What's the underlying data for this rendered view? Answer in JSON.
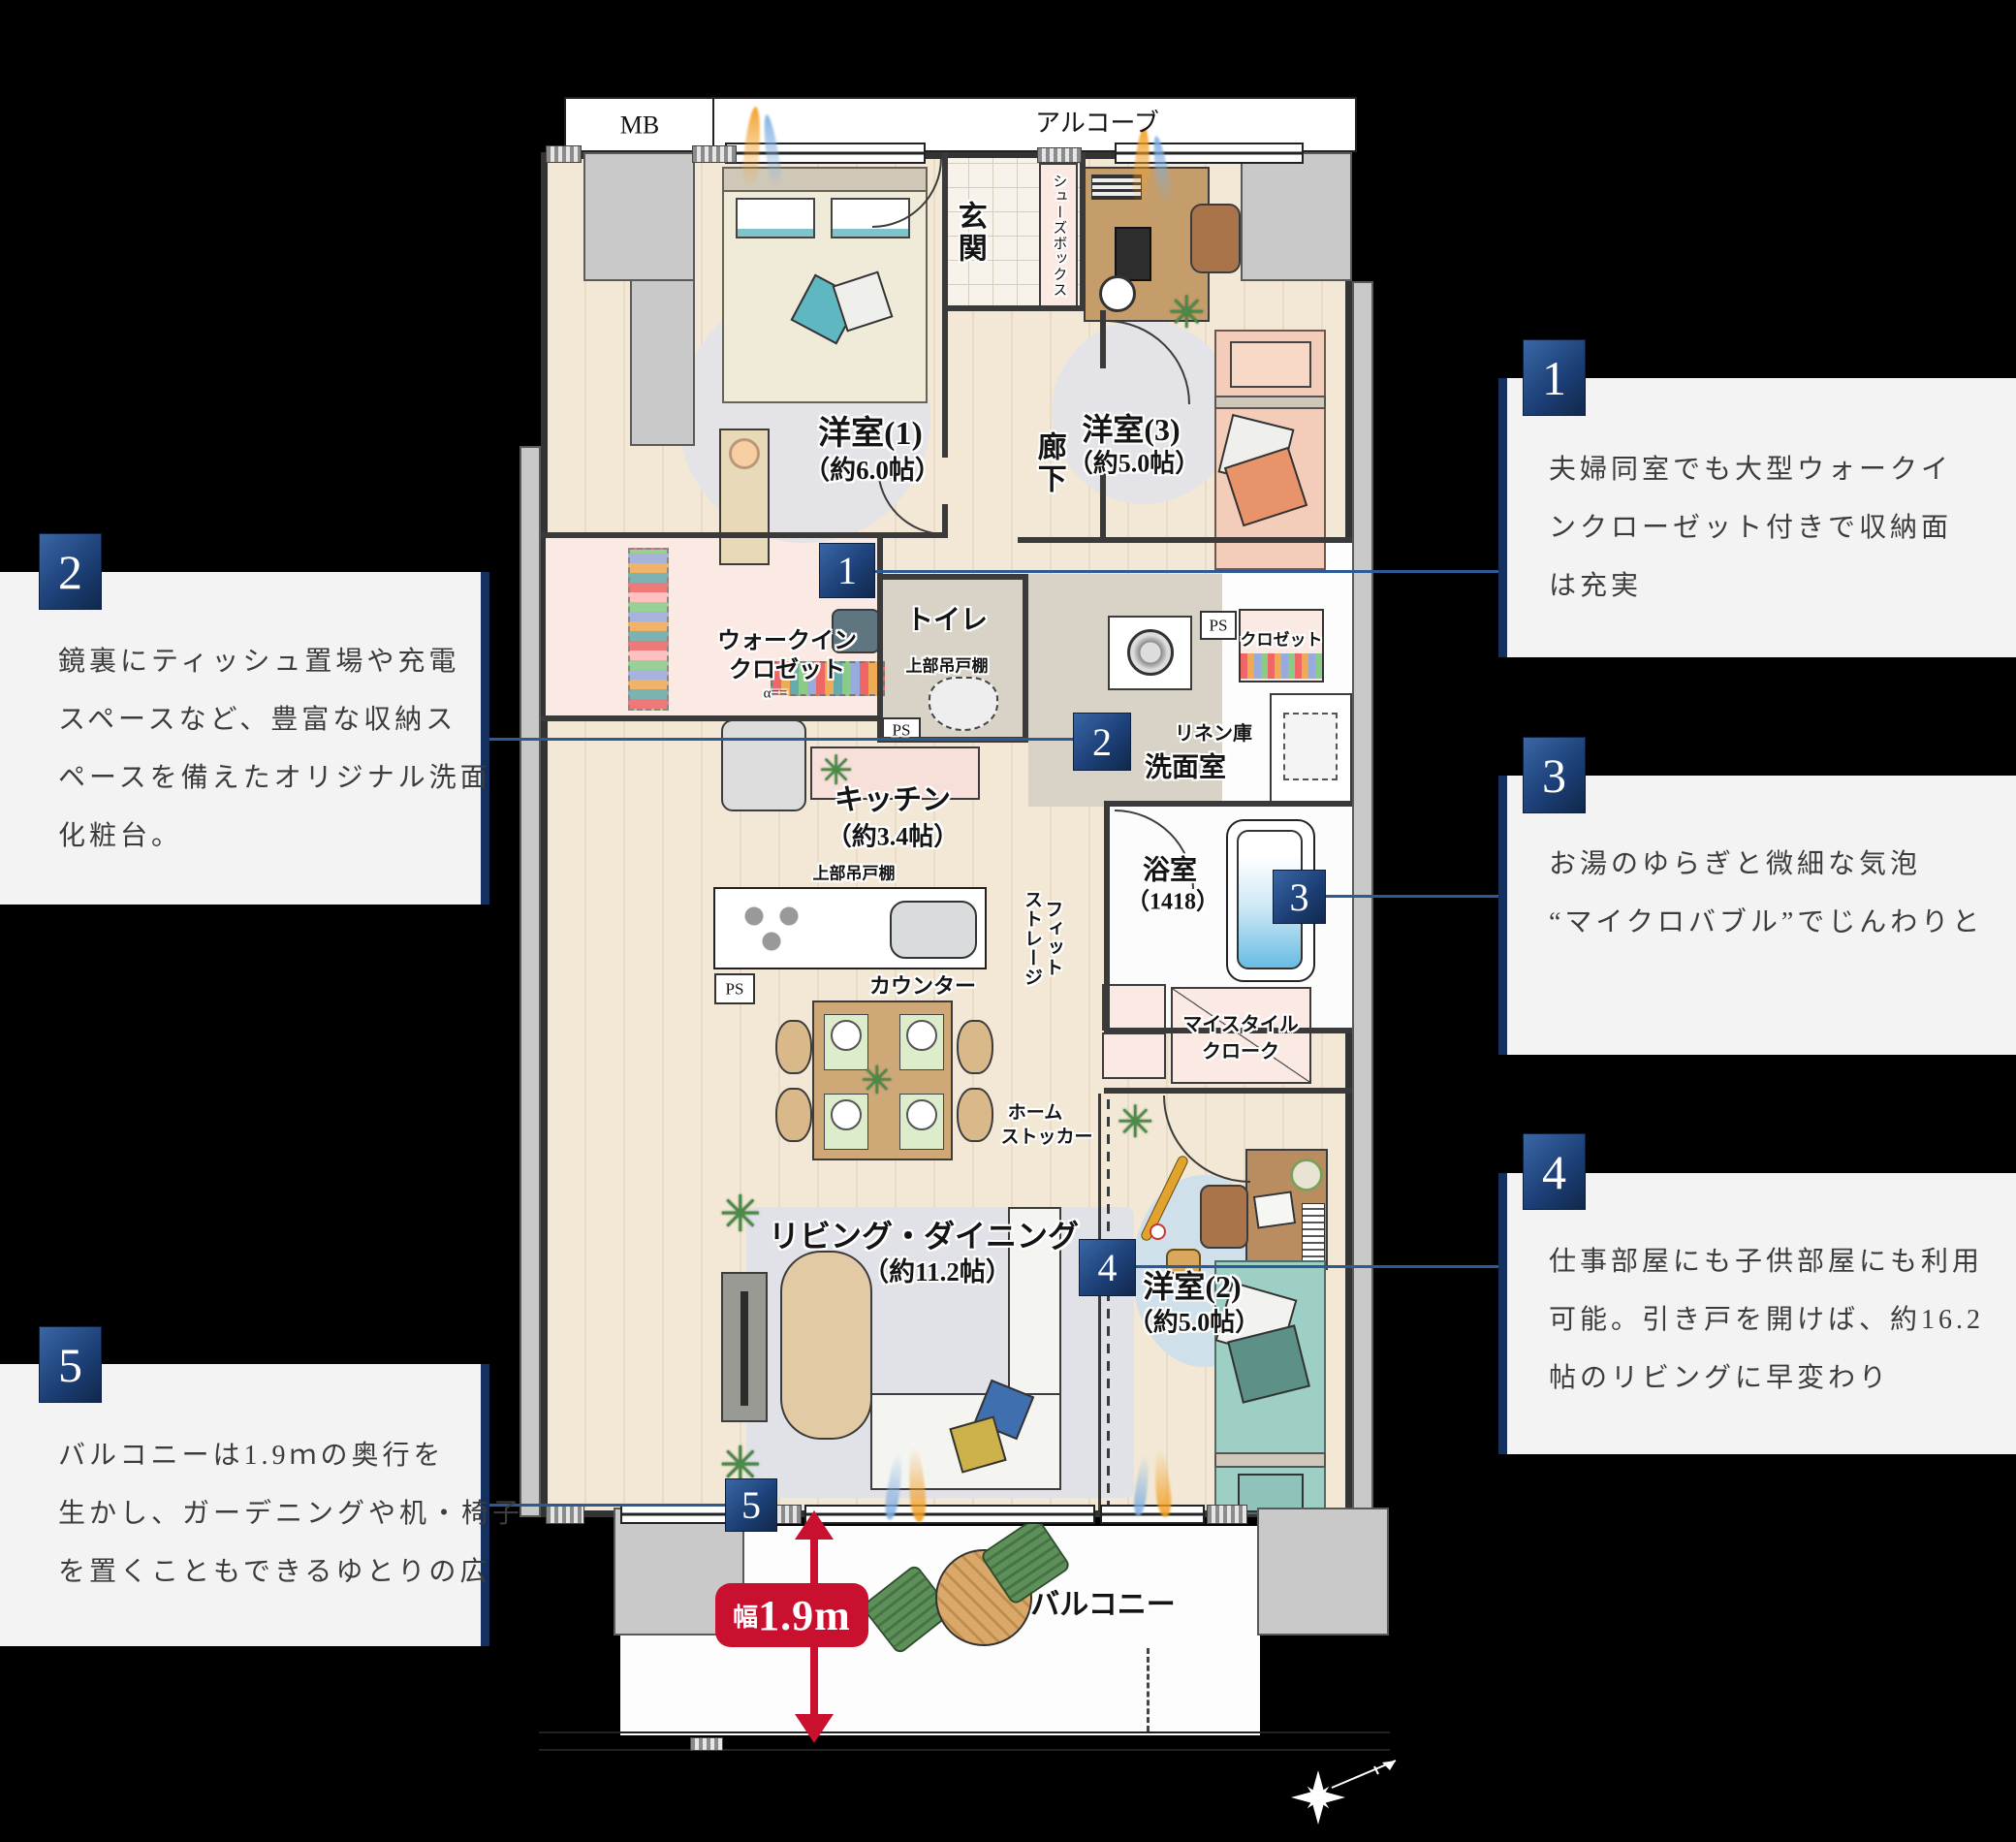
{
  "plan": {
    "header": {
      "mb": "MB",
      "alcove": "アルコーブ"
    },
    "rooms": {
      "bedroom1": {
        "name": "洋室(1)",
        "size": "（約6.0帖）"
      },
      "bedroom3": {
        "name": "洋室(3)",
        "size": "（約5.0帖）"
      },
      "bedroom2": {
        "name": "洋室(2)",
        "size": "（約5.0帖）"
      },
      "living": {
        "name": "リビング・ダイニング",
        "size": "（約11.2帖）"
      },
      "kitchen": {
        "name": "キッチン",
        "size": "（約3.4帖）"
      },
      "bath": {
        "name": "浴室",
        "size": "（1418）"
      },
      "genkan": "玄関",
      "corridor": "廊下",
      "toilet": "トイレ",
      "washroom": "洗面室",
      "linen": "リネン庫",
      "closet": "クロゼット",
      "shoes_box": "シューズボックス",
      "wic": [
        "ウォークイン",
        "クロゼット"
      ],
      "fit_storage": [
        "フィット",
        "ストレージ"
      ],
      "mystyle_cloak": [
        "マイスタイル",
        "クローク"
      ],
      "home_stocker": [
        "ホーム",
        "ストッカー"
      ],
      "balcony": "バルコニー"
    },
    "labels": {
      "ps": "PS",
      "upper_cabinet": "上部吊戸棚",
      "counter": "カウンター",
      "hanger_mark": "α=="
    },
    "dimension": {
      "prefix": "幅",
      "value": "1.9m"
    }
  },
  "callouts": [
    {
      "num": "1",
      "lines": [
        "夫婦同室でも大型ウォークイ",
        "ンクローゼット付きで収納面",
        "は充実"
      ]
    },
    {
      "num": "2",
      "lines": [
        "鏡裏にティッシュ置場や充電",
        "スペースなど、豊富な収納ス",
        "ペースを備えたオリジナル洗面",
        "化粧台。"
      ]
    },
    {
      "num": "3",
      "lines": [
        "お湯のゆらぎと微細な気泡",
        "“マイクロバブル”でじんわりと"
      ]
    },
    {
      "num": "4",
      "lines": [
        "仕事部屋にも子供部屋にも利用",
        "可能。引き戸を開けば、約16.2",
        "帖のリビングに早変わり"
      ]
    },
    {
      "num": "5",
      "lines": [
        "バルコニーは1.9ｍの奥行を",
        "生かし、ガーデニングや机・椅子",
        "を置くこともできるゆとりの広"
      ]
    }
  ],
  "colors": {
    "accent_navy": "#14305f",
    "badge_navy": "#1d4078",
    "connector_blue": "#2b5a96",
    "dimension_red": "#c9102f",
    "callout_bg": "#f3f3f4"
  }
}
